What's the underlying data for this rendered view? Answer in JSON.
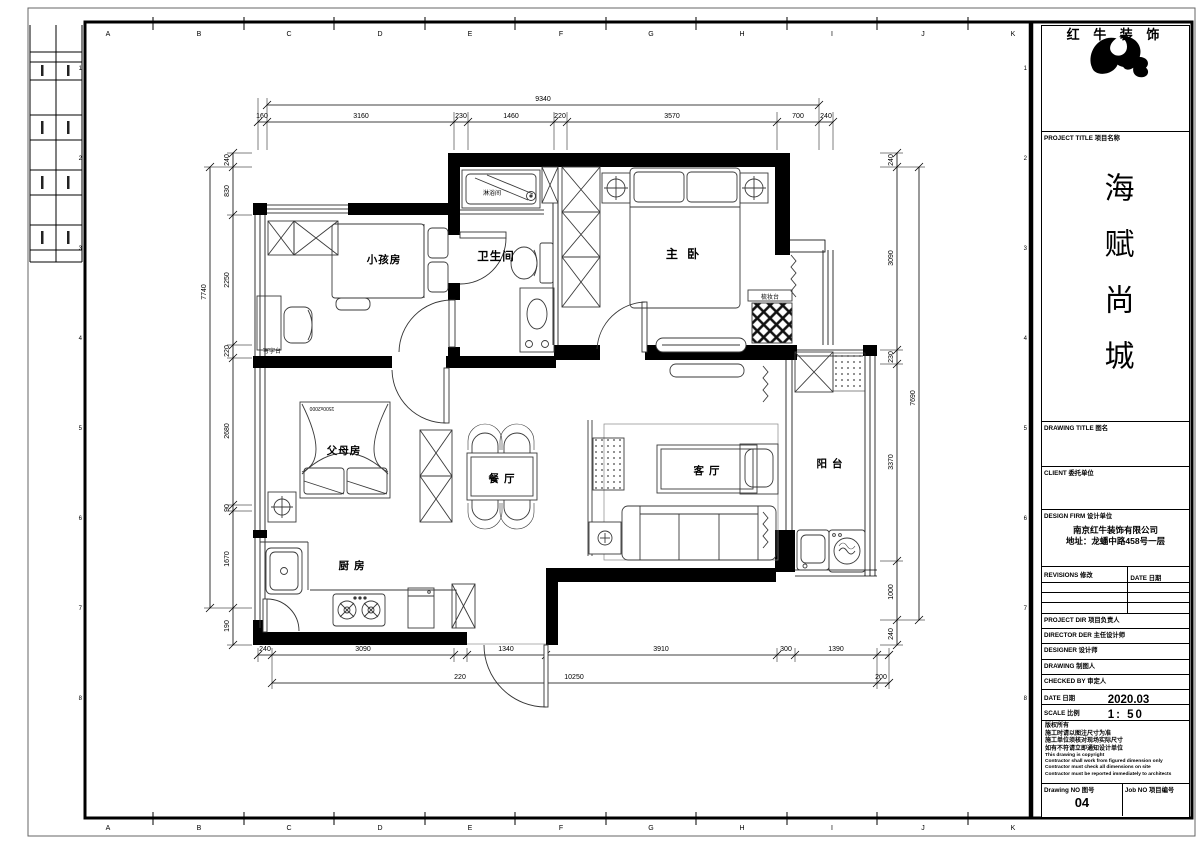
{
  "grid": {
    "letters": [
      "A",
      "B",
      "C",
      "D",
      "E",
      "F",
      "G",
      "H",
      "I",
      "J",
      "K"
    ],
    "numbers": [
      "1",
      "2",
      "3",
      "4",
      "5",
      "6",
      "7",
      "8"
    ]
  },
  "dims": {
    "top_total": "9340",
    "top": [
      "160",
      "3160",
      "230",
      "1460",
      "220",
      "3570",
      "700",
      "240"
    ],
    "bottom_row1": [
      "240",
      "3090",
      "1340",
      "3910",
      "300",
      "1390"
    ],
    "bottom_row2": [
      "220",
      "10250",
      "200"
    ],
    "left": [
      "240",
      "830",
      "2250",
      "220",
      "2680",
      "90",
      "1670",
      "190"
    ],
    "left_total": "7740",
    "right": [
      "240",
      "3090",
      "230",
      "3370",
      "1000",
      "240"
    ],
    "right_total": "7690"
  },
  "rooms": {
    "children": "小孩房",
    "shower": "淋浴间",
    "bath": "卫生间",
    "master": "主 卧",
    "parents": "父母房",
    "dining": "餐 厅",
    "living": "客 厅",
    "balcony": "阳 台",
    "kitchen": "厨 房",
    "desk": "写字台",
    "dresser": "梳妆台",
    "bed_size": "1500x2000"
  },
  "title_block": {
    "logo_text": "红 牛 装 饰",
    "project_label": "PROJECT TITLE  项目名称",
    "project_name": "海赋尚城",
    "drawing_label": "DRAWING TITLE  图名",
    "client_label": "CLIENT  委托单位",
    "design_firm_label": "DESIGN FIRM  设计单位",
    "design_firm_name": "南京红牛装饰有限公司",
    "design_firm_address": "地址：龙蟠中路458号一层",
    "revisions_label": "REVISIONS  修改",
    "date_col_label": "DATE  日期",
    "project_dir_label": "PROJECT DIR  项目负责人",
    "director_label": "DIRECTOR DER  主任设计师",
    "designer_label": "DESIGNER  设计师",
    "drawing_by_label": "DRAWING  制图人",
    "checked_by_label": "CHECKED BY  审定人",
    "date_label": "DATE  日期",
    "date_value": "2020.03",
    "scale_label": "SCALE  比例",
    "scale_value": "1: 50",
    "notes": [
      "版权所有",
      "施工时请以图注尺寸为准",
      "施工单位须核对现场实际尺寸",
      "如有不符请立即通知设计单位",
      "This drawing is copyright",
      "Contractor shall work from figured dimension only",
      "Contractor must check all dimensions on site",
      "Contractor must be reported immediately to architects"
    ],
    "drawing_no_label": "Drawing NO  图号",
    "drawing_no_value": "04",
    "job_no_label": "Job NO  项目编号"
  }
}
